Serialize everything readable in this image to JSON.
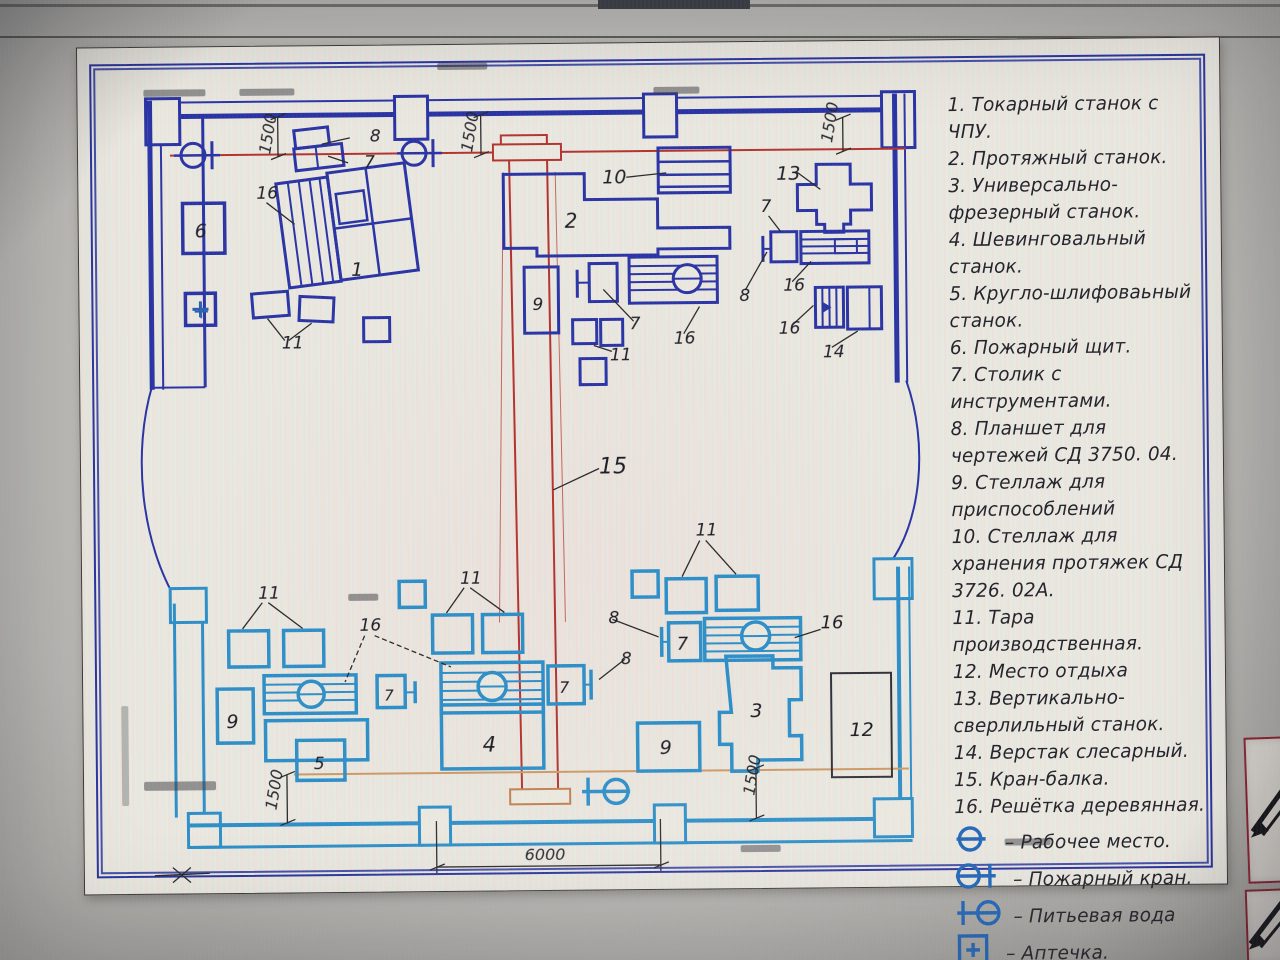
{
  "colors": {
    "plan_dark_blue": "#2a34a4",
    "plan_light_blue": "#2e8fc8",
    "crane_red": "#b23430",
    "rail_orange": "#cc9a66",
    "legend_symbol_blue": "#2166b8",
    "sheet_background": "#eae8df",
    "tool_card_border": "#8b2433"
  },
  "legend": {
    "items": [
      {
        "num": "1.",
        "text": "Токарный станок с ЧПУ."
      },
      {
        "num": "2.",
        "text": "Протяжный станок."
      },
      {
        "num": "3.",
        "text": "Универсально-фрезерный станок."
      },
      {
        "num": "4.",
        "text": "Шевинговальный станок."
      },
      {
        "num": "5.",
        "text": "Кругло-шлифоваьный станок."
      },
      {
        "num": "6.",
        "text": "Пожарный щит."
      },
      {
        "num": "7.",
        "text": "Столик с инструментами."
      },
      {
        "num": "8.",
        "text": "Планшет для чертежей СД 3750. 04."
      },
      {
        "num": "9.",
        "text": "Стеллаж для приспособлений"
      },
      {
        "num": "10.",
        "text": "Стеллаж для хранения протяжек СД 3726. 02А."
      },
      {
        "num": "11.",
        "text": "Тара производственная."
      },
      {
        "num": "12.",
        "text": "Место отдыха"
      },
      {
        "num": "13.",
        "text": "Вертикально-сверлильный станок."
      },
      {
        "num": "14.",
        "text": "Верстак слесарный."
      },
      {
        "num": "15.",
        "text": "Кран-балка."
      },
      {
        "num": "16.",
        "text": "Решётка деревянная."
      }
    ],
    "symbols": [
      {
        "icon": "work-place",
        "text": "– Рабочее место."
      },
      {
        "icon": "fire-hydrant",
        "text": "– Пожарный кран."
      },
      {
        "icon": "drinking-water",
        "text": "– Питьевая вода"
      },
      {
        "icon": "first-aid",
        "text": "– Аптечка."
      }
    ]
  },
  "plan": {
    "labels": [
      {
        "t": "8",
        "x": 372,
        "y": 138
      },
      {
        "t": "7",
        "x": 366,
        "y": 164
      },
      {
        "t": "16",
        "x": 258,
        "y": 194
      },
      {
        "t": "1",
        "x": 352,
        "y": 272,
        "fs": 19
      },
      {
        "t": "6",
        "x": 196,
        "y": 232,
        "fs": 19
      },
      {
        "t": "+",
        "x": 193,
        "y": 313,
        "fs": 21,
        "c": "#2a5fb0"
      },
      {
        "t": "11",
        "x": 282,
        "y": 344
      },
      {
        "t": "10",
        "x": 604,
        "y": 182,
        "fs": 19
      },
      {
        "t": "2",
        "x": 566,
        "y": 226,
        "fs": 20
      },
      {
        "t": "9",
        "x": 533,
        "y": 308
      },
      {
        "t": "7",
        "x": 630,
        "y": 328
      },
      {
        "t": "16",
        "x": 674,
        "y": 343
      },
      {
        "t": "11",
        "x": 610,
        "y": 359
      },
      {
        "t": "15",
        "x": 598,
        "y": 472,
        "fs": 22
      },
      {
        "t": "13",
        "x": 778,
        "y": 180,
        "fs": 19
      },
      {
        "t": "7",
        "x": 762,
        "y": 212
      },
      {
        "t": "16",
        "x": 784,
        "y": 291
      },
      {
        "t": "8",
        "x": 740,
        "y": 301
      },
      {
        "t": "16",
        "x": 779,
        "y": 334
      },
      {
        "t": "14",
        "x": 823,
        "y": 358
      },
      {
        "t": "11",
        "x": 256,
        "y": 594
      },
      {
        "t": "16",
        "x": 357,
        "y": 627
      },
      {
        "t": "11",
        "x": 458,
        "y": 581
      },
      {
        "t": "9",
        "x": 223,
        "y": 723,
        "fs": 19
      },
      {
        "t": "7",
        "x": 381,
        "y": 697,
        "fs": 15
      },
      {
        "t": "5",
        "x": 310,
        "y": 765
      },
      {
        "t": "4",
        "x": 479,
        "y": 749,
        "fs": 21
      },
      {
        "t": "8",
        "x": 606,
        "y": 622
      },
      {
        "t": "8",
        "x": 618,
        "y": 663
      },
      {
        "t": "7",
        "x": 674,
        "y": 649,
        "fs": 18
      },
      {
        "t": "7",
        "x": 556,
        "y": 691,
        "fs": 16
      },
      {
        "t": "16",
        "x": 818,
        "y": 629,
        "fs": 18
      },
      {
        "t": "3",
        "x": 747,
        "y": 717,
        "fs": 19
      },
      {
        "t": "9",
        "x": 656,
        "y": 753,
        "fs": 19
      },
      {
        "t": "11",
        "x": 694,
        "y": 535
      },
      {
        "t": "12",
        "x": 846,
        "y": 737,
        "fs": 19
      }
    ],
    "dimensions": [
      {
        "t": "1500",
        "x": 272,
        "y": 150,
        "rot": -80
      },
      {
        "t": "1500",
        "x": 474,
        "y": 150,
        "rot": -80
      },
      {
        "t": "1500",
        "x": 834,
        "y": 144,
        "rot": -80
      },
      {
        "t": "1500",
        "x": 272,
        "y": 806,
        "rot": -80
      },
      {
        "t": "1500",
        "x": 750,
        "y": 796,
        "rot": -80
      },
      {
        "t": "6000",
        "x": 520,
        "y": 858,
        "rot": 0
      }
    ]
  }
}
